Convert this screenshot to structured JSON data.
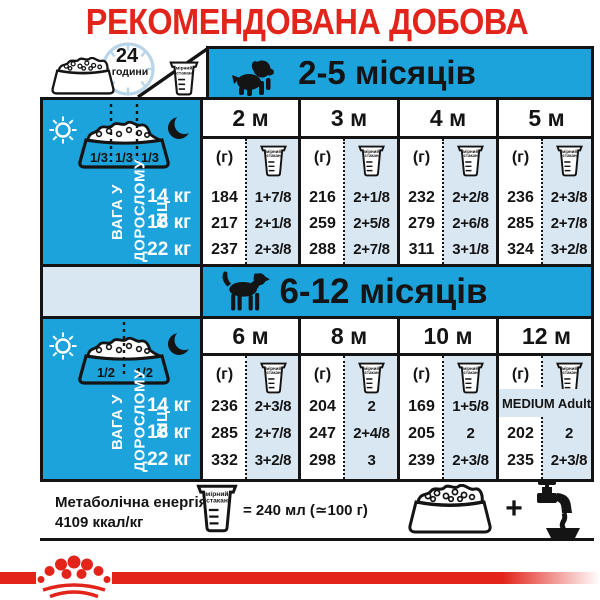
{
  "title": "РЕКОМЕНДОВАНА ДОБОВА НОРМА",
  "colors": {
    "red": "#E2241B",
    "cyan": "#1CA3DC",
    "light_blue": "#D9E7F3",
    "ink": "#141414"
  },
  "top": {
    "hours": "24",
    "hours_unit": "години"
  },
  "cup": {
    "line1": "мірний",
    "line2": "стакан"
  },
  "side": {
    "label_line1": "ВАГА У",
    "label_line2": "ДОРОСЛОМУ ВІЦІ"
  },
  "table1": {
    "title": "2-5 місяців",
    "months": [
      "2 м",
      "3 м",
      "4 м",
      "5 м"
    ],
    "grams_unit": "(г)",
    "portions": [
      "1/3",
      "1/3",
      "1/3"
    ],
    "rows": [
      {
        "weight": "14 кг",
        "values": [
          [
            "184",
            "1+7/8"
          ],
          [
            "216",
            "2+1/8"
          ],
          [
            "232",
            "2+2/8"
          ],
          [
            "236",
            "2+3/8"
          ]
        ]
      },
      {
        "weight": "18 кг",
        "values": [
          [
            "217",
            "2+1/8"
          ],
          [
            "259",
            "2+5/8"
          ],
          [
            "279",
            "2+6/8"
          ],
          [
            "285",
            "2+7/8"
          ]
        ]
      },
      {
        "weight": "22 кг",
        "values": [
          [
            "237",
            "2+3/8"
          ],
          [
            "288",
            "2+7/8"
          ],
          [
            "311",
            "3+1/8"
          ],
          [
            "324",
            "3+2/8"
          ]
        ]
      }
    ]
  },
  "table2": {
    "title": "6-12 місяців",
    "months": [
      "6 м",
      "8 м",
      "10 м",
      "12 м"
    ],
    "grams_unit": "(г)",
    "portions": [
      "1/2",
      "1/2"
    ],
    "medium_adult": "MEDIUM Adult",
    "rows": [
      {
        "weight": "14 кг",
        "values": [
          [
            "236",
            "2+3/8"
          ],
          [
            "204",
            "2"
          ],
          [
            "169",
            "1+5/8"
          ]
        ]
      },
      {
        "weight": "18 кг",
        "values": [
          [
            "285",
            "2+7/8"
          ],
          [
            "247",
            "2+4/8"
          ],
          [
            "205",
            "2"
          ],
          [
            "202",
            "2"
          ]
        ]
      },
      {
        "weight": "22 кг",
        "values": [
          [
            "332",
            "3+2/8"
          ],
          [
            "298",
            "3"
          ],
          [
            "239",
            "2+3/8"
          ],
          [
            "235",
            "2+3/8"
          ]
        ]
      }
    ]
  },
  "footer": {
    "energy_label": "Метаболічна енергія:",
    "energy_value": "4109 ккал/кг",
    "cup_equiv": "= 240 мл (≃100 г)",
    "plus": "+"
  }
}
